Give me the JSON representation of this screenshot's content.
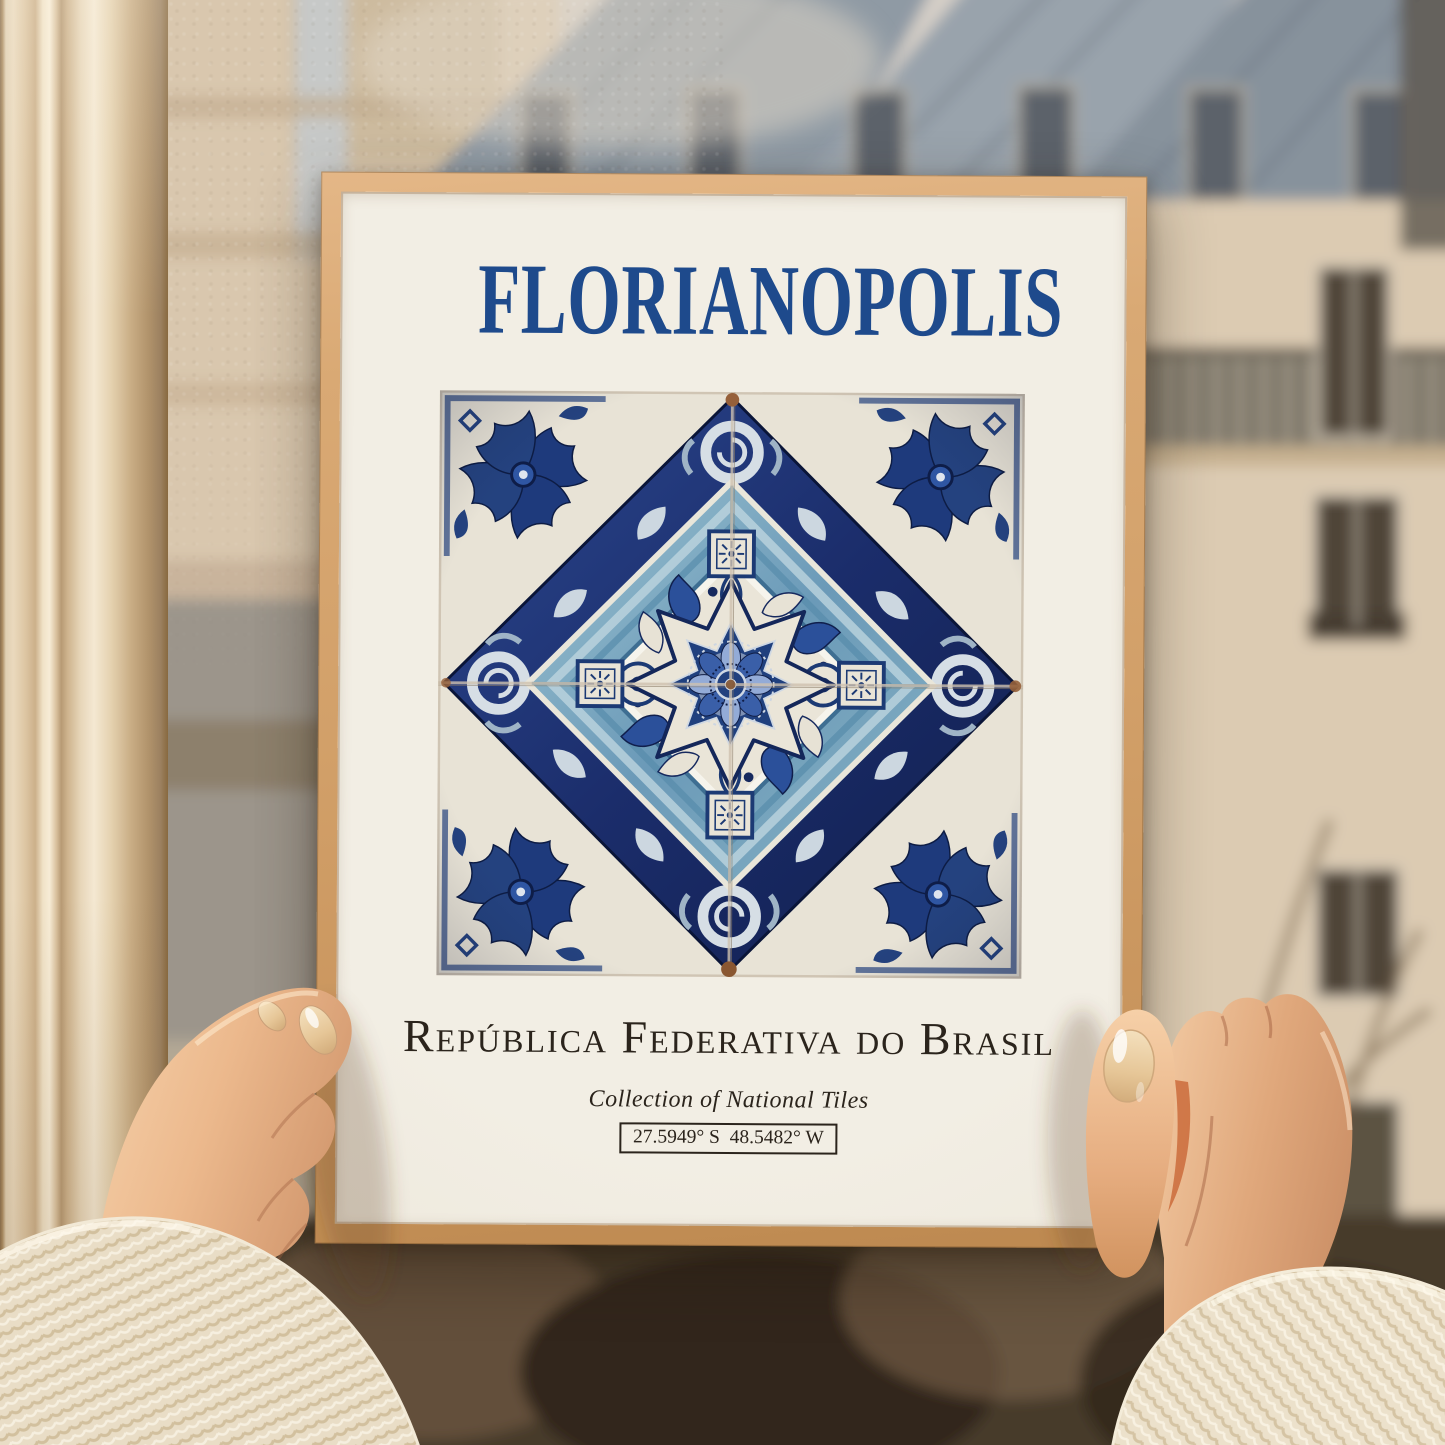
{
  "poster": {
    "title": "FLORIANOPOLIS",
    "subtitle": "República Federativa do Brasil",
    "collection_label": "Collection of National Tiles",
    "coordinates": "27.5949° S  48.5482° W"
  },
  "scene": {
    "subject": "two hands holding a framed tile-art poster up in front of a window",
    "background": "blurred Parisian building facades with slate mansard roofs and bare tree branches"
  },
  "colors": {
    "title_blue": "#1e4a8c",
    "poster_paper": "#f2eee4",
    "frame_wood": "#d2a069",
    "tile_navy": "#1b2d6b",
    "tile_mid_blue": "#2d55a5",
    "tile_light_blue": "#8ea9d6",
    "tile_teal": "#7ea8bf",
    "tile_white": "#eae5d8",
    "text_dark": "#2b241c",
    "window_frame_cream": "#e7d7ba",
    "sweater_cream": "#e9ddc6",
    "skin_tone": "#e8b48c"
  }
}
